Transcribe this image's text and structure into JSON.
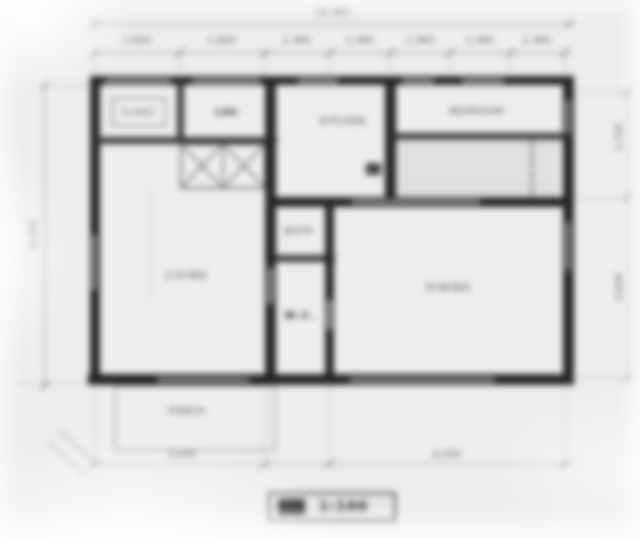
{
  "plan": {
    "rooms": {
      "closet_top": "CLOSET",
      "lavatory": "LAV.",
      "kitchen": "KITCHEN",
      "bedroom": "BEDROOM",
      "living": "LIVING",
      "bath": "BATH",
      "wc": "W.C.",
      "dining": "DINING",
      "porch": "PORCH"
    },
    "dimensions": {
      "top_overall": "10,465",
      "top_segments": [
        "1,820",
        "1,820",
        "1,365",
        "1,365",
        "1,365",
        "1,365",
        "1,365"
      ],
      "left_overall": "6,370",
      "right_segments": [
        "2,730",
        "3,640"
      ],
      "bottom_segments": [
        "3,640",
        "4,550"
      ]
    },
    "stamp": {
      "prefix": "S=",
      "scale": "1:100"
    },
    "colors": {
      "wall": "#242424",
      "paper": "#ededec",
      "line": "#888888"
    }
  }
}
